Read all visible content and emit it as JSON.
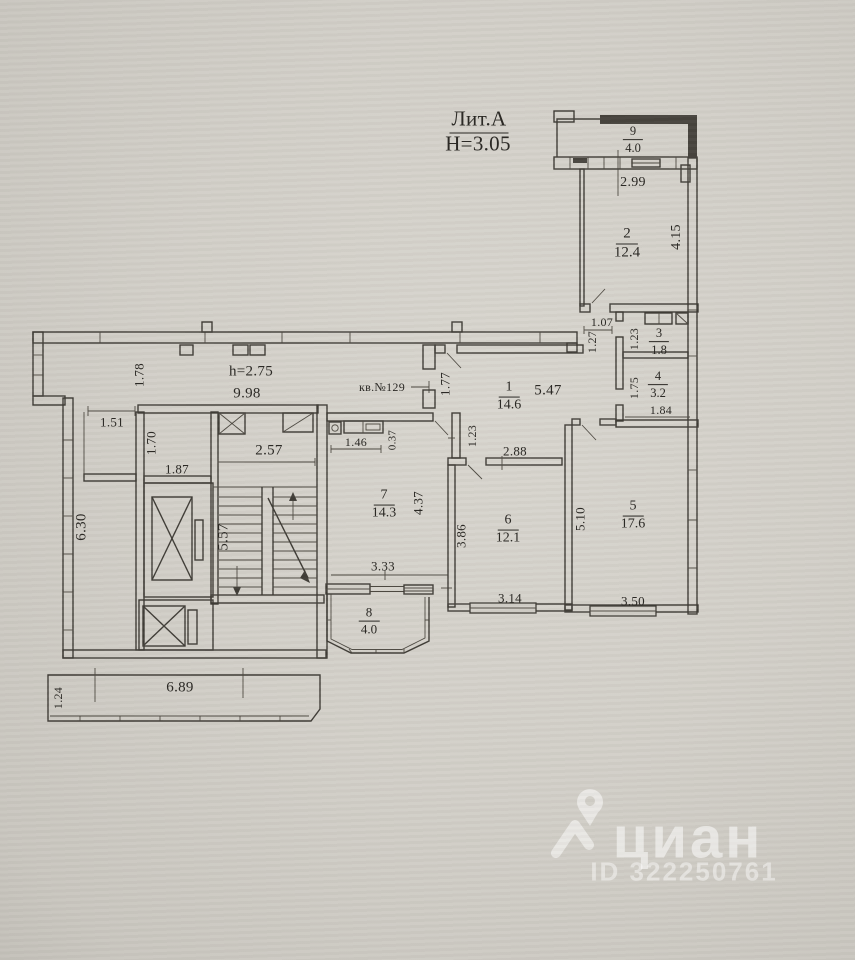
{
  "title": {
    "litera": "Лит.А",
    "height_mark": "Н=3.05"
  },
  "corridor": {
    "ceiling": "h=2.75",
    "length": "9.98",
    "apartment": "кв.№129"
  },
  "rooms": {
    "r1": {
      "num": "1",
      "area": "14.6"
    },
    "r2": {
      "num": "2",
      "area": "12.4"
    },
    "r3": {
      "num": "3",
      "area": "1.8"
    },
    "r4": {
      "num": "4",
      "area": "3.2"
    },
    "r5": {
      "num": "5",
      "area": "17.6"
    },
    "r6": {
      "num": "6",
      "area": "12.1"
    },
    "r7": {
      "num": "7",
      "area": "14.3"
    },
    "r8": {
      "num": "8",
      "area": "4.0"
    },
    "r9": {
      "num": "9",
      "area": "4.0"
    }
  },
  "dims": {
    "balcony9_width": "2.99",
    "room2_height": "4.15",
    "nook_width": "1.07",
    "nook_height": "1.27",
    "room3_height": "1.23",
    "room4_height": "1.75",
    "room4_width": "1.84",
    "room1_width": "5.47",
    "entry_wall": "1.77",
    "corridor_width": "1.78",
    "vestibule_door": "1.51",
    "vestibule_height": "1.70",
    "cell_width": "1.87",
    "hall_height": "6.30",
    "stairs_width": "2.57",
    "stairs_height": "5.57",
    "kitchen_counter": "1.46",
    "kitchen_offset": "0.37",
    "room7_height": "4.37",
    "room7_width": "3.33",
    "room6_top": "2.88",
    "room6_wall": "1.23",
    "room6_height": "3.86",
    "room6_width": "3.14",
    "room5_height": "5.10",
    "room5_width": "3.50",
    "balcony_width": "6.89",
    "balcony_depth": "1.24"
  },
  "watermark": {
    "brand": "циан",
    "listing_id": "ID 322250761"
  },
  "colors": {
    "paper": "#d2cfc8",
    "ink": "#3e3b35",
    "balcony_wall": "#45423c",
    "watermark": "#ffffff"
  }
}
